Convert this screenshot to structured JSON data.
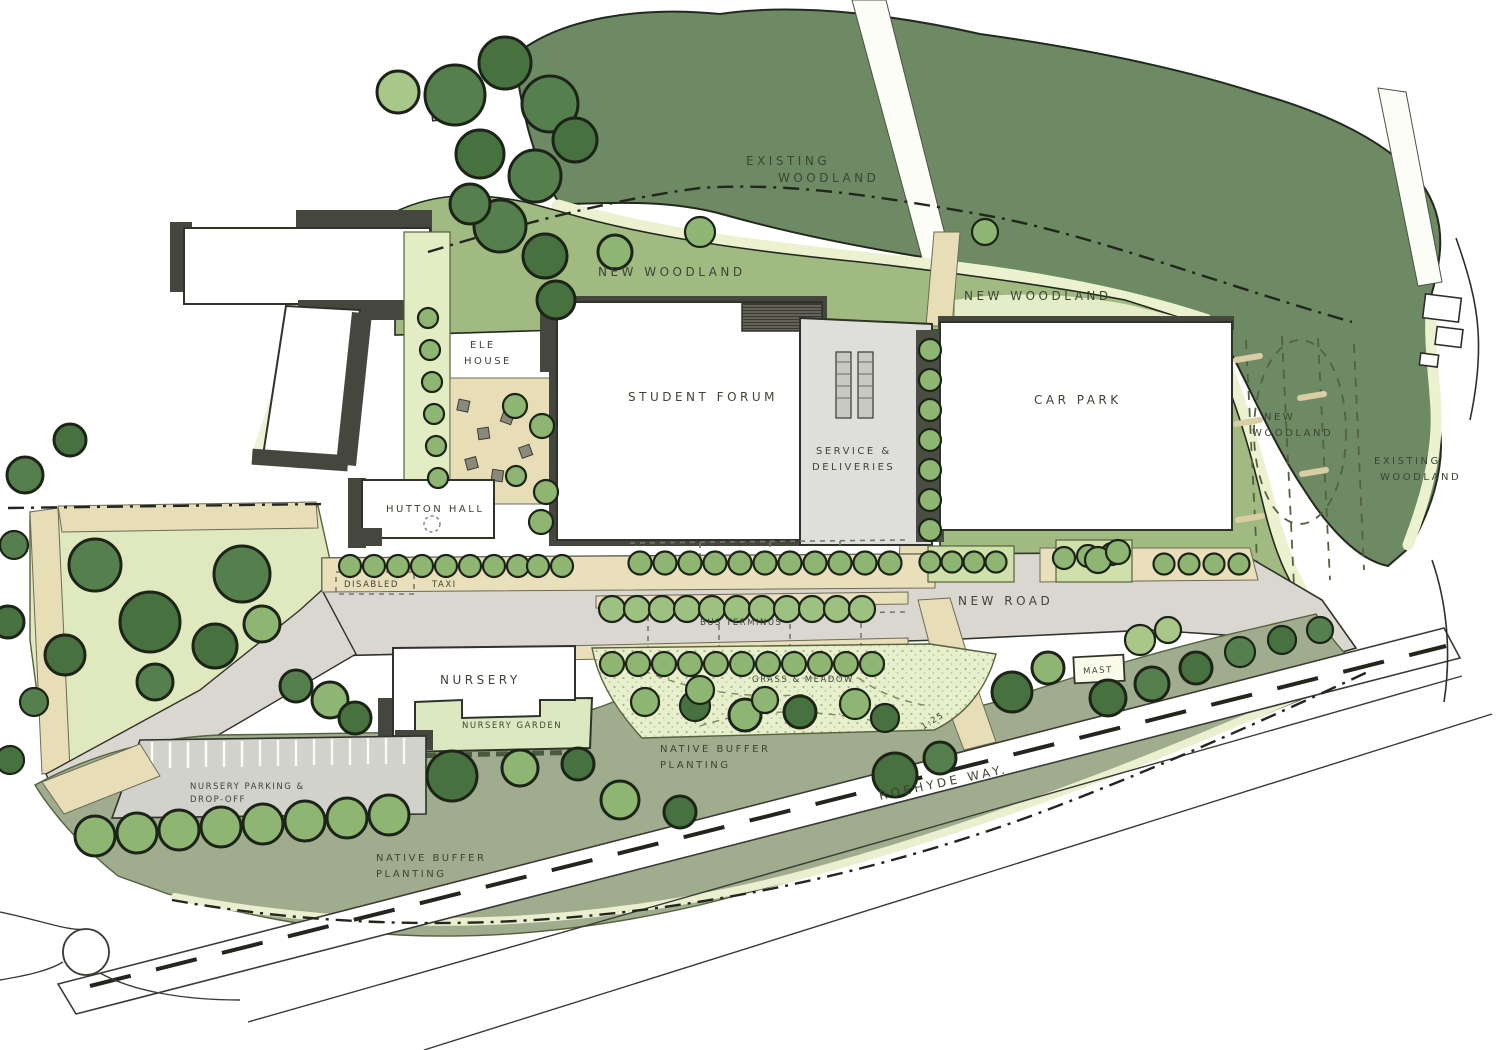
{
  "title": "Landscape masterplan sketch",
  "palette": {
    "woodland_dark": "#6e8a64",
    "woodland_new": "#a0ba82",
    "tree_dark": "#567f4e",
    "tree_mid": "#8fb573",
    "tree_light": "#a9c789",
    "cream_fringe": "#ecf2d0",
    "lawn": "#dfe9bd",
    "meadow": "#e8efcd",
    "buffer_sage": "#9fac8d",
    "path_tan": "#e7ddb6",
    "road_grey": "#dad7d1",
    "building_white": "#ffffff",
    "shadow_grey": "#45463e",
    "ink": "#3d4434"
  },
  "labels": {
    "existing_woodland_top": {
      "lines": [
        "EXISTING",
        "WOODLAND"
      ]
    },
    "new_woodland_left": {
      "text": "NEW WOODLAND"
    },
    "new_woodland_mid": {
      "text": "NEW WOODLAND"
    },
    "new_woodland_right": {
      "lines": [
        "NEW",
        "WOODLAND"
      ]
    },
    "existing_woodland_right": {
      "lines": [
        "EXISTING",
        "WOODLAND"
      ]
    },
    "ele_house": {
      "lines": [
        "ELE",
        "HOUSE"
      ]
    },
    "student_forum": {
      "text": "STUDENT FORUM"
    },
    "car_park": {
      "text": "CAR PARK"
    },
    "service_deliveries": {
      "lines": [
        "SERVICE &",
        "DELIVERIES"
      ]
    },
    "hutton_hall": {
      "text": "HUTTON HALL"
    },
    "disabled_bay": {
      "text": "DISABLED"
    },
    "taxi_bay": {
      "text": "TAXI"
    },
    "new_road": {
      "text": "NEW ROAD"
    },
    "bus_terminus": {
      "text": "BUS TERMINUS"
    },
    "nursery": {
      "text": "NURSERY"
    },
    "nursery_garden": {
      "text": "NURSERY GARDEN"
    },
    "grass_meadow": {
      "text": "GRASS & MEADOW"
    },
    "mast": {
      "text": "MAST"
    },
    "native_buffer_mid": {
      "lines": [
        "NATIVE BUFFER",
        "PLANTING"
      ]
    },
    "nursery_parking": {
      "lines": [
        "NURSERY PARKING &",
        "DROP-OFF"
      ]
    },
    "roehyde_way": {
      "text": "ROEHYDE WAY."
    },
    "native_buffer_bottom": {
      "lines": [
        "NATIVE BUFFER",
        "PLANTING"
      ]
    },
    "gradient_mark": {
      "text": "1:25"
    }
  }
}
